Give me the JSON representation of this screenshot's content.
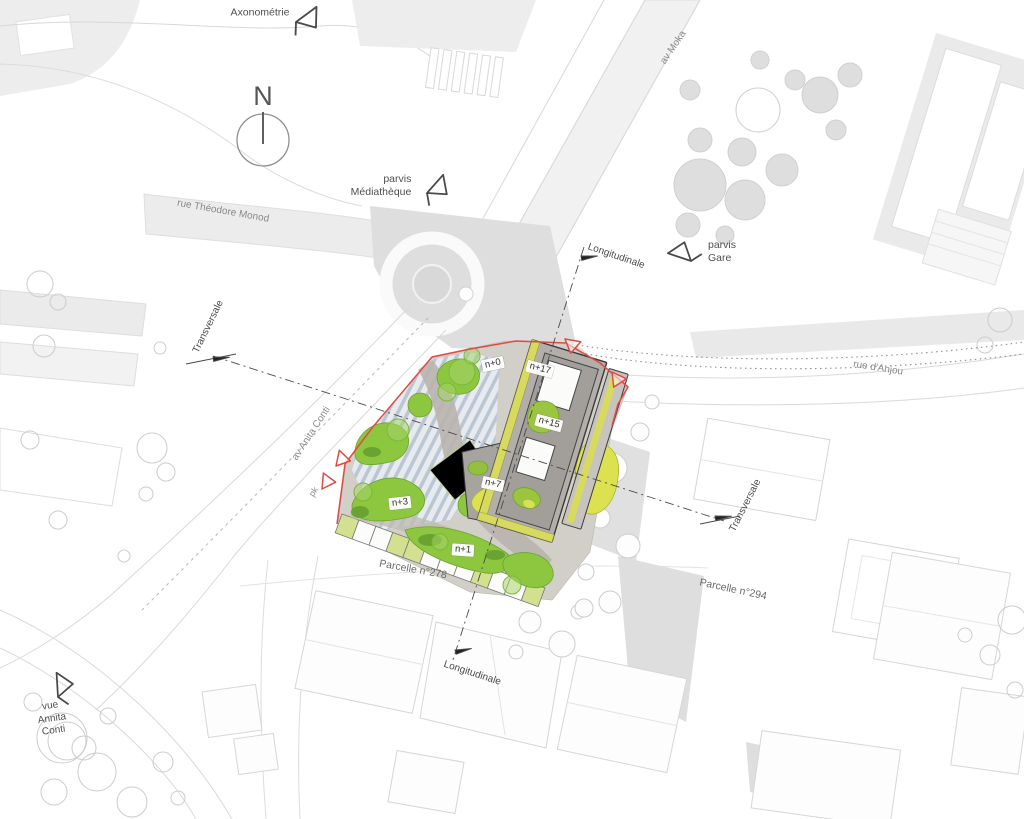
{
  "annotations": {
    "compass": {
      "label": "N"
    },
    "views": {
      "axonometrie": {
        "label": "Axonométrie"
      },
      "parvis_mediatheque": {
        "line1": "parvis",
        "line2": "Médiathèque"
      },
      "parvis_gare": {
        "line1": "parvis",
        "line2": "Gare"
      },
      "vue_annita_conti": {
        "line1": "vue",
        "line2": "Annita",
        "line3": "Conti"
      }
    },
    "sections": {
      "longitudinale_top": {
        "label": "Longitudinale"
      },
      "longitudinale_bottom": {
        "label": "Longitudinale"
      },
      "transversale_left": {
        "label": "Transversale"
      },
      "transversale_right": {
        "label": "Transversale"
      }
    },
    "streets": {
      "av_moka": {
        "label": "av Moka"
      },
      "rue_theodore_monod": {
        "label": "rue Théodore Monod"
      },
      "rue_d_anjou": {
        "label": "rue d'Anjou"
      },
      "av_anita_conti": {
        "label": "av Anita Conti"
      },
      "pk": {
        "label": "pk"
      }
    },
    "parcels": {
      "parcelle_278": {
        "label": "Parcelle n°278"
      },
      "parcelle_294": {
        "label": "Parcelle n°294"
      }
    },
    "building_levels": {
      "n0": {
        "label": "n+0"
      },
      "n17": {
        "label": "n+17"
      },
      "n15": {
        "label": "n+15"
      },
      "n7": {
        "label": "n+7"
      },
      "n3": {
        "label": "n+3"
      },
      "n1": {
        "label": "n+1"
      }
    }
  },
  "colors": {
    "site_boundary_red": "#e04b41",
    "landscape_green": "#8dc63f",
    "landscape_green_dark": "#69a332",
    "planted_yellow_green": "#dce24f",
    "canopy_blue_gray": "#b7c5d4",
    "roof_gray": "#b2aea9",
    "context_gray": "#e9e9e9",
    "annotation_text": "#4a4a4a"
  }
}
